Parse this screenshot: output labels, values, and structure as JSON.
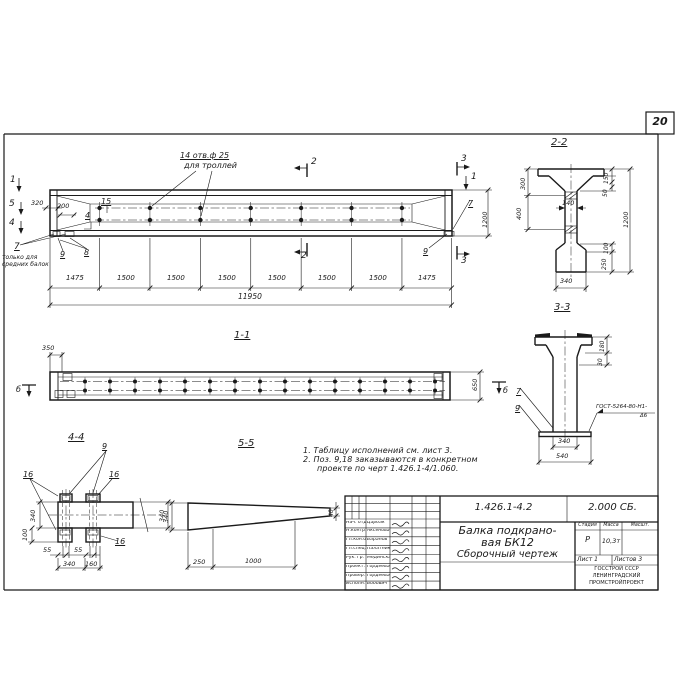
{
  "colors": {
    "ink": "#1a1a1a",
    "paper": "#ffffff"
  },
  "sheet_number": "20",
  "notes": {
    "line1": "1. Таблицу исполнений см. лист 3.",
    "line2": "2. Поз. 9,18 заказываются в конкретном",
    "line3": "проекте по черт 1.426.1-4/1.060."
  },
  "title_block": {
    "doc_number": "1.426.1-4.2",
    "doc_code": "2.000 СБ.",
    "title_line1": "Балка подкрано-",
    "title_line2": "вая БК12",
    "title_line3": "Сборочный чертеж",
    "stage_label": "Стадия",
    "mass_label": "Масса",
    "scale_label": "Масшт.",
    "stage_value": "Р",
    "mass_value": "10,3т",
    "sheet_label": "Лист 1",
    "sheets_label": "Листов 3",
    "org_line1": "ГОССТРОЙ СССР",
    "org_line2": "ЛЕНИНГРАДСКИЙ",
    "org_line3": "ПРОМСТРОЙПРОЕКТ",
    "staff": [
      {
        "role": "Нач. отд",
        "name": "Царбак"
      },
      {
        "role": "Н.контр.",
        "name": "Аксенова"
      },
      {
        "role": "Гл.кон.от",
        "name": "Баранов"
      },
      {
        "role": "Гл.спец.",
        "name": "Палатников"
      },
      {
        "role": "Рук. гр.",
        "name": "Мединская"
      },
      {
        "role": "Проект.",
        "name": "Гордеева"
      },
      {
        "role": "Провер.",
        "name": "Гордеева"
      },
      {
        "role": "Исполн.",
        "name": "Бобович"
      }
    ]
  },
  "annotations": [
    {
      "n": "holes-callout-line1",
      "t": "14 отв.ф 25",
      "x": 180,
      "y": 152,
      "s": 8,
      "u": true
    },
    {
      "n": "holes-callout-line2",
      "t": "для троллей",
      "x": 184,
      "y": 162,
      "s": 8
    },
    {
      "n": "section-mark-1-left",
      "t": "1",
      "x": 10,
      "y": 176,
      "s": 9
    },
    {
      "n": "section-mark-5-left",
      "t": "5",
      "x": 9,
      "y": 200,
      "s": 9
    },
    {
      "n": "section-mark-4-left",
      "t": "4",
      "x": 9,
      "y": 219,
      "s": 9
    },
    {
      "n": "dim-320",
      "t": "320",
      "x": 31,
      "y": 200,
      "s": 6.5
    },
    {
      "n": "dim-200",
      "t": "200",
      "x": 57,
      "y": 203,
      "s": 6.5
    },
    {
      "n": "pos-15",
      "t": "15",
      "x": 101,
      "y": 198,
      "s": 8,
      "u": true
    },
    {
      "n": "pos-4",
      "t": "4",
      "x": 85,
      "y": 212,
      "s": 8,
      "u": true
    },
    {
      "n": "pos-7",
      "t": "7",
      "x": 14,
      "y": 243,
      "s": 9,
      "u": true
    },
    {
      "n": "elevation-note-line1",
      "t": "только для",
      "x": 2,
      "y": 255,
      "s": 6
    },
    {
      "n": "elevation-note-line2",
      "t": "средних балок",
      "x": 2,
      "y": 262,
      "s": 6
    },
    {
      "n": "pos-9",
      "t": "9",
      "x": 60,
      "y": 251,
      "s": 8,
      "u": true
    },
    {
      "n": "pos-8",
      "t": "8",
      "x": 84,
      "y": 249,
      "s": 8,
      "u": true
    },
    {
      "n": "section-mark-2-top",
      "t": "2",
      "x": 311,
      "y": 158,
      "s": 9
    },
    {
      "n": "section-mark-2-bottom",
      "t": "2",
      "x": 301,
      "y": 252,
      "s": 9
    },
    {
      "n": "section-mark-3-top",
      "t": "3",
      "x": 461,
      "y": 155,
      "s": 9
    },
    {
      "n": "section-mark-3-bottom",
      "t": "3",
      "x": 461,
      "y": 257,
      "s": 9
    },
    {
      "n": "section-mark-1-right",
      "t": "1",
      "x": 471,
      "y": 173,
      "s": 9
    },
    {
      "n": "pos-7-right",
      "t": "7",
      "x": 468,
      "y": 200,
      "s": 8,
      "u": true
    },
    {
      "n": "pos-9-right",
      "t": "9",
      "x": 423,
      "y": 248,
      "s": 8,
      "u": true
    },
    {
      "n": "dim-1200-elevation",
      "t": "1200",
      "x": 482,
      "y": 228,
      "s": 6.5,
      "r": -90
    },
    {
      "n": "dim-span",
      "t": "1475",
      "x": 66,
      "y": 275,
      "s": 7
    },
    {
      "n": "dim-span",
      "t": "1500",
      "x": 117,
      "y": 275,
      "s": 7
    },
    {
      "n": "dim-span",
      "t": "1500",
      "x": 167,
      "y": 275,
      "s": 7
    },
    {
      "n": "dim-span",
      "t": "1500",
      "x": 218,
      "y": 275,
      "s": 7
    },
    {
      "n": "dim-span",
      "t": "1500",
      "x": 268,
      "y": 275,
      "s": 7
    },
    {
      "n": "dim-span",
      "t": "1500",
      "x": 318,
      "y": 275,
      "s": 7
    },
    {
      "n": "dim-span",
      "t": "1500",
      "x": 369,
      "y": 275,
      "s": 7
    },
    {
      "n": "dim-span",
      "t": "1475",
      "x": 418,
      "y": 275,
      "s": 7
    },
    {
      "n": "dim-total",
      "t": "11950",
      "x": 238,
      "y": 293,
      "s": 7.5
    },
    {
      "n": "view-title-1-1",
      "t": "1-1",
      "x": 234,
      "y": 331,
      "s": 10,
      "u": true
    },
    {
      "n": "dim-350",
      "t": "350",
      "x": 42,
      "y": 345,
      "s": 6.5
    },
    {
      "n": "dim-650",
      "t": "650",
      "x": 472,
      "y": 391,
      "s": 6.5,
      "r": -90
    },
    {
      "n": "section-mark-b-left",
      "t": "б",
      "x": 16,
      "y": 386,
      "s": 8
    },
    {
      "n": "section-mark-b-right",
      "t": "б",
      "x": 503,
      "y": 387,
      "s": 8
    },
    {
      "n": "view-title-4-4",
      "t": "4-4",
      "x": 68,
      "y": 433,
      "s": 10,
      "u": true
    },
    {
      "n": "pos-9-44",
      "t": "9",
      "x": 102,
      "y": 443,
      "s": 8,
      "u": true
    },
    {
      "n": "pos-16-a",
      "t": "16",
      "x": 23,
      "y": 471,
      "s": 8,
      "u": true
    },
    {
      "n": "pos-16-b",
      "t": "16",
      "x": 109,
      "y": 471,
      "s": 8,
      "u": true
    },
    {
      "n": "pos-16-c",
      "t": "16",
      "x": 115,
      "y": 538,
      "s": 8,
      "u": true
    },
    {
      "n": "dim-340-44-left",
      "t": "340",
      "x": 30,
      "y": 522,
      "s": 6.5,
      "r": -90
    },
    {
      "n": "dim-100-44",
      "t": "100",
      "x": 22,
      "y": 541,
      "s": 6.5,
      "r": -90
    },
    {
      "n": "dim-340-44-right",
      "t": "340",
      "x": 159,
      "y": 522,
      "s": 6.5,
      "r": -90
    },
    {
      "n": "dim-55-a",
      "t": "55",
      "x": 43,
      "y": 547,
      "s": 6.5
    },
    {
      "n": "dim-55-b",
      "t": "55",
      "x": 74,
      "y": 547,
      "s": 6.5
    },
    {
      "n": "dim-340-44-bottom",
      "t": "340",
      "x": 63,
      "y": 561,
      "s": 6.5
    },
    {
      "n": "dim-160-44",
      "t": "160",
      "x": 85,
      "y": 561,
      "s": 6.5
    },
    {
      "n": "view-title-5-5",
      "t": "5-5",
      "x": 238,
      "y": 439,
      "s": 10,
      "u": true
    },
    {
      "n": "dim-340-55",
      "t": "340",
      "x": 163,
      "y": 523,
      "s": 6.5,
      "r": -90
    },
    {
      "n": "dim-40-55",
      "t": "40",
      "x": 329,
      "y": 517,
      "s": 6,
      "r": -90
    },
    {
      "n": "dim-250-55",
      "t": "250",
      "x": 193,
      "y": 559,
      "s": 6.5
    },
    {
      "n": "dim-1000-55",
      "t": "1000",
      "x": 245,
      "y": 558,
      "s": 6.5
    },
    {
      "n": "view-title-2-2",
      "t": "2-2",
      "x": 551,
      "y": 138,
      "s": 10,
      "u": true
    },
    {
      "n": "dim-300-22",
      "t": "300",
      "x": 520,
      "y": 190,
      "s": 6.5,
      "r": -90
    },
    {
      "n": "dim-400-22",
      "t": "400",
      "x": 516,
      "y": 220,
      "s": 6.5,
      "r": -90
    },
    {
      "n": "dim-140-22",
      "t": "140",
      "x": 562,
      "y": 200,
      "s": 6.5
    },
    {
      "n": "dim-150-22",
      "t": "150",
      "x": 604,
      "y": 184,
      "s": 6,
      "r": -90
    },
    {
      "n": "dim-50-22",
      "t": "50",
      "x": 603,
      "y": 197,
      "s": 6,
      "r": -90
    },
    {
      "n": "dim-1200-22",
      "t": "1200",
      "x": 623,
      "y": 228,
      "s": 6.5,
      "r": -90
    },
    {
      "n": "dim-100-22",
      "t": "100",
      "x": 604,
      "y": 254,
      "s": 6,
      "r": -90
    },
    {
      "n": "dim-250-22",
      "t": "250",
      "x": 602,
      "y": 270,
      "s": 6,
      "r": -90
    },
    {
      "n": "dim-340-22",
      "t": "340",
      "x": 560,
      "y": 278,
      "s": 6.5
    },
    {
      "n": "view-title-3-3",
      "t": "3-3",
      "x": 554,
      "y": 303,
      "s": 10,
      "u": true
    },
    {
      "n": "pos-7-33",
      "t": "7",
      "x": 516,
      "y": 388,
      "s": 8,
      "u": true
    },
    {
      "n": "pos-9-33",
      "t": "9",
      "x": 515,
      "y": 405,
      "s": 8,
      "u": true
    },
    {
      "n": "dim-180-33",
      "t": "180",
      "x": 600,
      "y": 352,
      "s": 6,
      "r": -90
    },
    {
      "n": "dim-30-33",
      "t": "30",
      "x": 598,
      "y": 366,
      "s": 6,
      "r": -90
    },
    {
      "n": "weld-callout-line1",
      "t": "ГОСТ-5264-80-Н1-",
      "x": 596,
      "y": 405,
      "s": 5.5
    },
    {
      "n": "weld-callout-line2",
      "t": "Δ6",
      "x": 640,
      "y": 414,
      "s": 5.5
    },
    {
      "n": "dim-340-33",
      "t": "340",
      "x": 558,
      "y": 438,
      "s": 6.5
    },
    {
      "n": "dim-540-33",
      "t": "540",
      "x": 556,
      "y": 453,
      "s": 6.5
    }
  ]
}
